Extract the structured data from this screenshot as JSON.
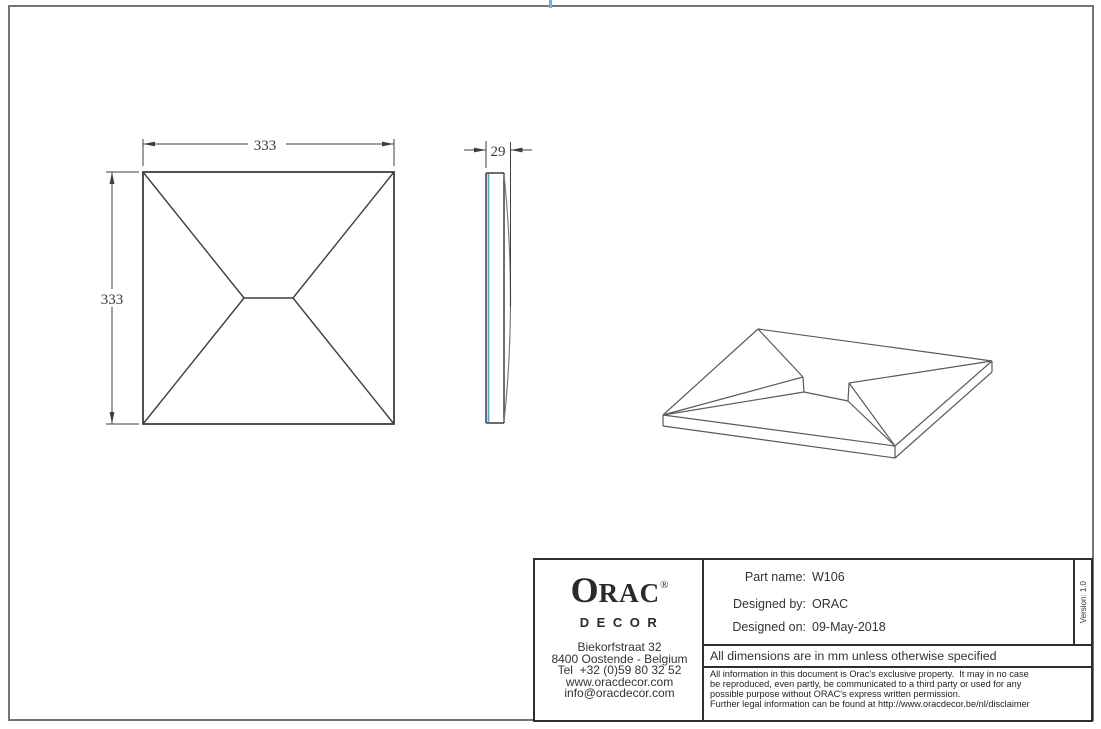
{
  "drawing": {
    "front_view": {
      "width_label": "333",
      "height_label": "333"
    },
    "side_view": {
      "thickness_label": "29"
    }
  },
  "title_block": {
    "logo": {
      "first_letter": "O",
      "rest": "RAC",
      "registered": "®",
      "sub_brand": "DECOR"
    },
    "address": [
      "Biekorfstraat 32",
      "8400 Oostende - Belgium",
      "Tel  +32 (0)59 80 32 52",
      "www.oracdecor.com",
      "info@oracdecor.com"
    ],
    "fields": [
      {
        "label": "Part name:",
        "value": "W106"
      },
      {
        "label": "Designed by:",
        "value": "ORAC"
      },
      {
        "label": "Designed on:",
        "value": "09-May-2018"
      }
    ],
    "version": "Version: 1.0",
    "dimension_note": "All dimensions are in mm unless otherwise specified",
    "disclaimer": [
      "All information in this document is Orac's exclusive property.  It may in no case",
      "be reproduced, even partly, be communicated to a third party or used for any",
      "possible purpose without ORAC's express written permission.",
      "Further legal information can be found at http://www.oracdecor.be/nl/disclaimer"
    ]
  },
  "colors": {
    "frame_gray": "#757575",
    "line_dark": "#3f3f3f",
    "iso_line": "#5a5a5a",
    "back_edge_cyan": "#55aacb",
    "top_tick_blue": "#65b6d0",
    "title_border": "#2e2e2e"
  }
}
